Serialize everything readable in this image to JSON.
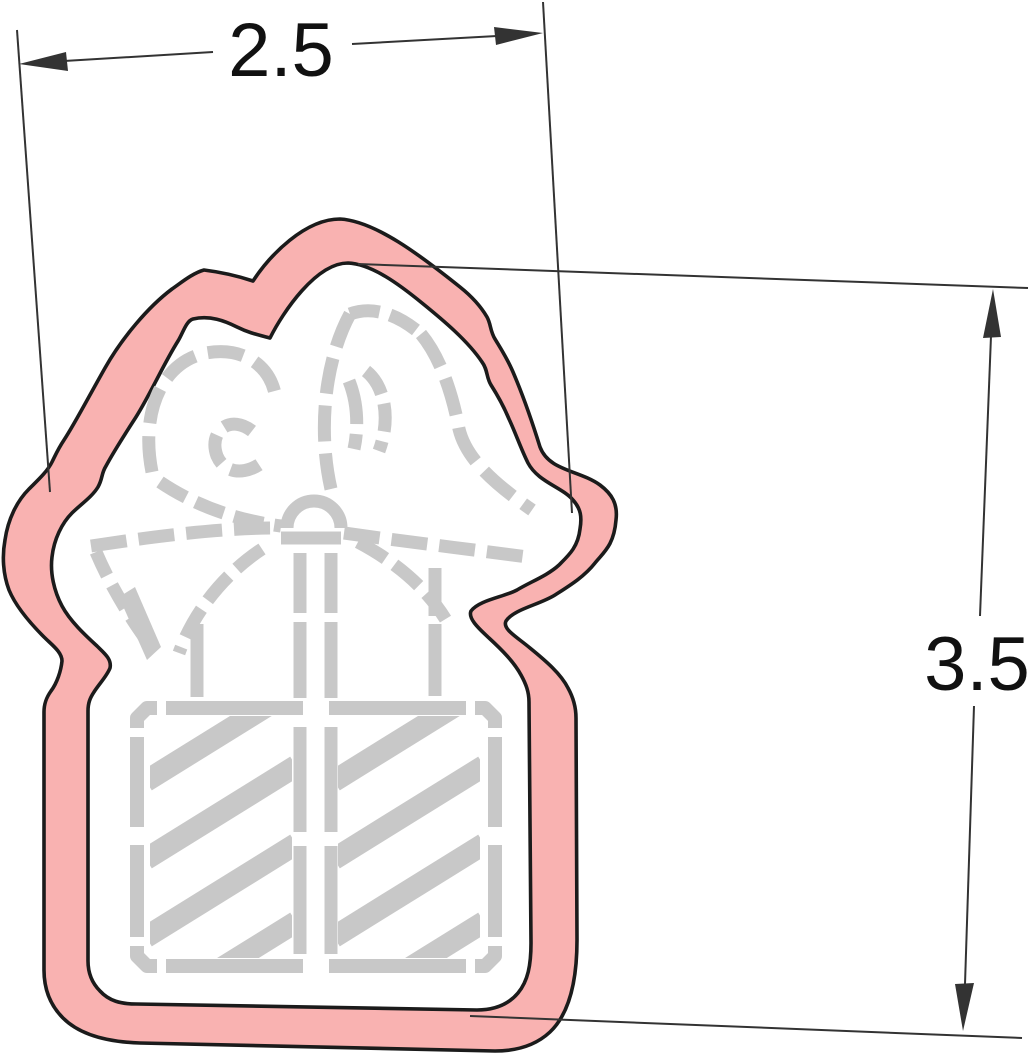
{
  "page": {
    "background_color": "#ffffff"
  },
  "colors": {
    "cutter_fill": "#f9b2b1",
    "cutter_outline": "#1b1b1b",
    "interior_fill": "#ffffff",
    "stencil_gray": "#c8c8c8",
    "dimension_line": "#333333",
    "label_text": "#111111"
  },
  "drawing": {
    "type": "cookie-cutter-dimension-diagram",
    "subject": "gift-box-with-bow-cookie-cutter",
    "width_label": "2.5",
    "height_label": "3.5"
  }
}
